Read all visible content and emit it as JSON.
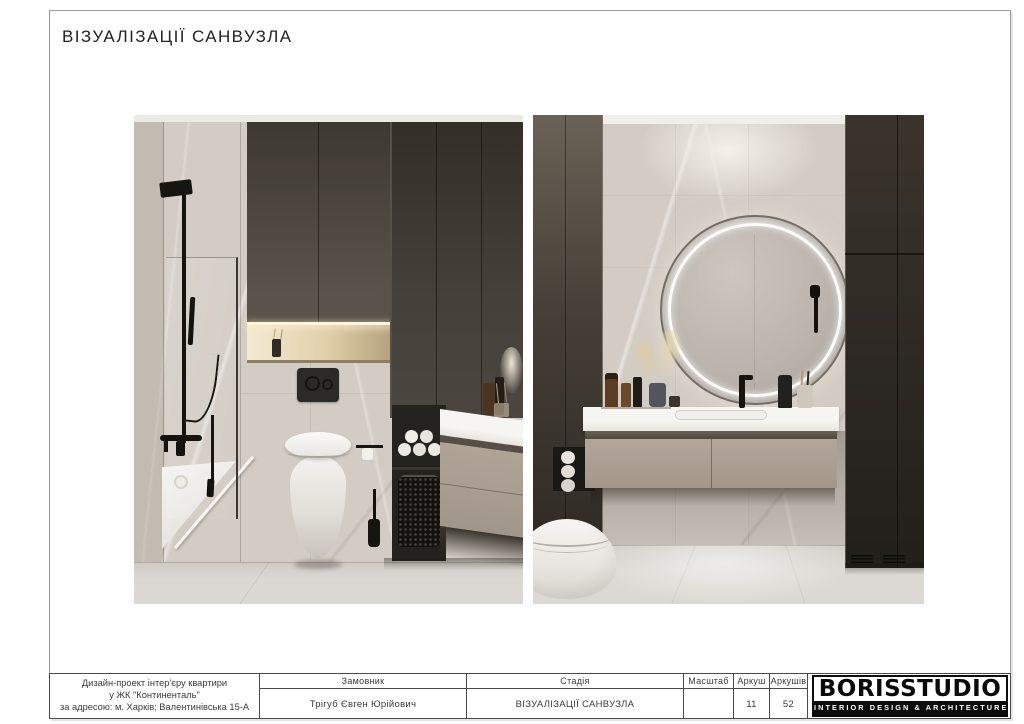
{
  "page": {
    "title": "ВІЗУАЛІЗАЦІЇ САНВУЗЛА"
  },
  "titleblock": {
    "project": {
      "line1": "Дизайн-проект інтер'єру квартири",
      "line2": "у ЖК \"Континенталь\"",
      "line3": "за адресою: м. Харків; Валентинівська 15-А"
    },
    "client": {
      "label": "Замовник",
      "value": "Трігуб Євген Юрійович"
    },
    "stage": {
      "label": "Стадія",
      "value": "ВІЗУАЛІЗАЦІЇ САНВУЗЛА"
    },
    "scale": {
      "label": "Масштаб",
      "value": ""
    },
    "sheet": {
      "label": "Аркуш",
      "value": "11"
    },
    "sheets": {
      "label": "Аркушів",
      "value": "52"
    },
    "logo": {
      "name": "BORISSTUDIO",
      "tagline": "INTERIOR DESIGN & ARCHITECTURE"
    }
  },
  "colors": {
    "frame_border": "#9b9b9b",
    "table_line": "#4a4a4a",
    "text": "#3a3a3a",
    "marble_wall": "#d2ccc4",
    "dark_cabinet": "#3a342c",
    "taupe_vanity": "#ab9f92",
    "niche_glow": "#f4ead3",
    "floor": "#dad6d1",
    "logo_black": "#0c0c0c"
  }
}
